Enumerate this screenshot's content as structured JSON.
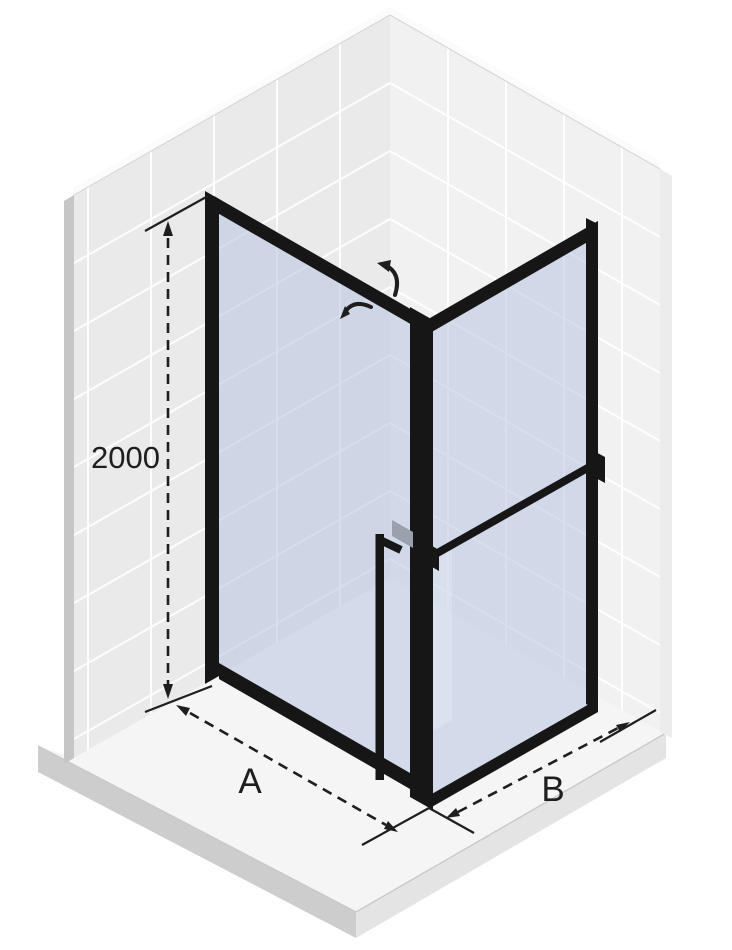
{
  "dimensions": {
    "height": {
      "label": "2000"
    },
    "width": {
      "label": "A"
    },
    "depth": {
      "label": "B"
    }
  },
  "icons": {
    "door_swing_out": "curved-arrow-up",
    "door_swing_in": "curved-arrow-left"
  },
  "colors": {
    "frame": "#161616",
    "glass": "#b7c4e2",
    "wall-left": "#eaeaea",
    "wall-right": "#f1f1f1",
    "wall-edge-left": "#c6c6c6",
    "wall-edge-right": "#ececec",
    "wall-top": "#fbfbfb",
    "grout": "#ffffff",
    "floor-top": "#f5f5f5",
    "floor-side-left": "#cdcdcd",
    "floor-side-right": "#e4e4e4",
    "handle-block": "#9aa1ad",
    "dim": "#1e1e1e"
  }
}
